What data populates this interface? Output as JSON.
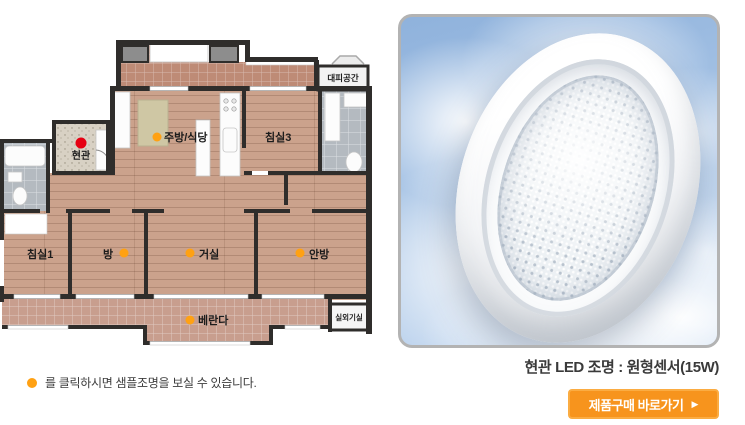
{
  "floor_plan": {
    "note_text": "를 클릭하시면 샘플조명을 보실 수 있습니다.",
    "rooms": [
      {
        "id": "evacuation-space",
        "label": "대피공간"
      },
      {
        "id": "kitchen-dining",
        "label": "주방/식당",
        "marker": "orange"
      },
      {
        "id": "bedroom3",
        "label": "침실3"
      },
      {
        "id": "entrance",
        "label": "현관",
        "marker": "red"
      },
      {
        "id": "bedroom1",
        "label": "침실1"
      },
      {
        "id": "room",
        "label": "방",
        "marker": "orange"
      },
      {
        "id": "living-room",
        "label": "거실",
        "marker": "orange"
      },
      {
        "id": "master-bedroom",
        "label": "안방",
        "marker": "orange"
      },
      {
        "id": "veranda",
        "label": "베란다",
        "marker": "orange"
      },
      {
        "id": "outdoor-unit-room",
        "label": "실외기실"
      }
    ]
  },
  "product": {
    "caption": "현관 LED 조명 : 원형센서(15W)",
    "buy_button": {
      "label": "제품구매 바로가기",
      "arrow": "▶"
    }
  },
  "colors": {
    "marker_orange": "#FFA113",
    "marker_red": "#E60012",
    "button_orange": "#F7941D",
    "button_border": "#FBAC42",
    "sky_blue": "#A6C3E5"
  }
}
